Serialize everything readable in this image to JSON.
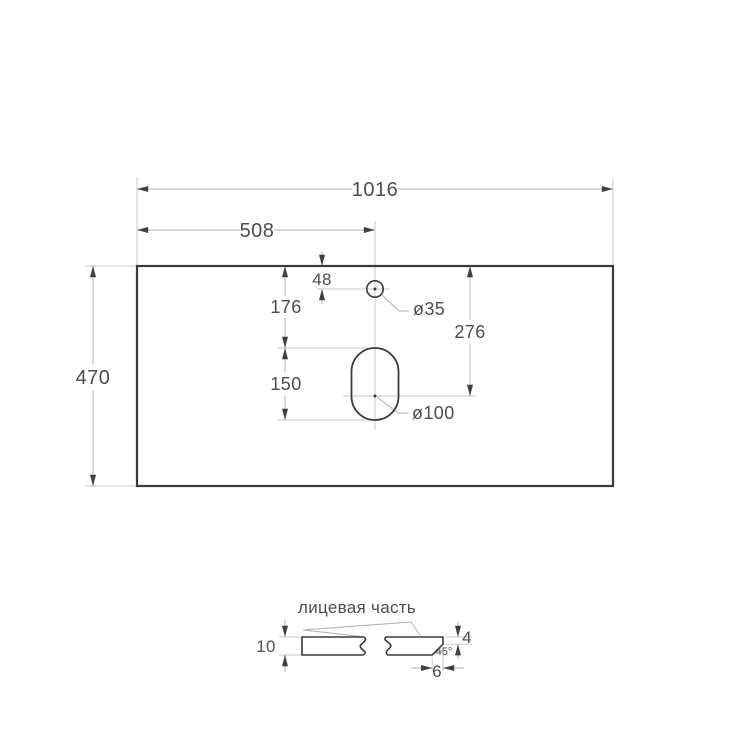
{
  "colors": {
    "background": "#ffffff",
    "outline": "#3a3a3a",
    "dimension_line": "#b0b0b0",
    "extension_line": "#c9c9c9",
    "arrow": "#3f3f3f",
    "hatch": "#8f8f8f",
    "text": "#4d4d4d"
  },
  "plan_view": {
    "dimensions": {
      "total_width": "1016",
      "half_width": "508",
      "depth": "470",
      "faucet_center_from_top": "48",
      "top_to_drain_top": "176",
      "drain_slot_length": "150",
      "top_to_drain_center": "276"
    },
    "hole_labels": {
      "faucet_hole_diameter": "ø35",
      "drain_hole_diameter": "ø100"
    }
  },
  "section_view": {
    "face_label": "лицевая часть",
    "dimensions": {
      "thickness": "10",
      "edge_face_height": "4",
      "chamfer_angle": "45°",
      "chamfer_width": "6"
    }
  }
}
